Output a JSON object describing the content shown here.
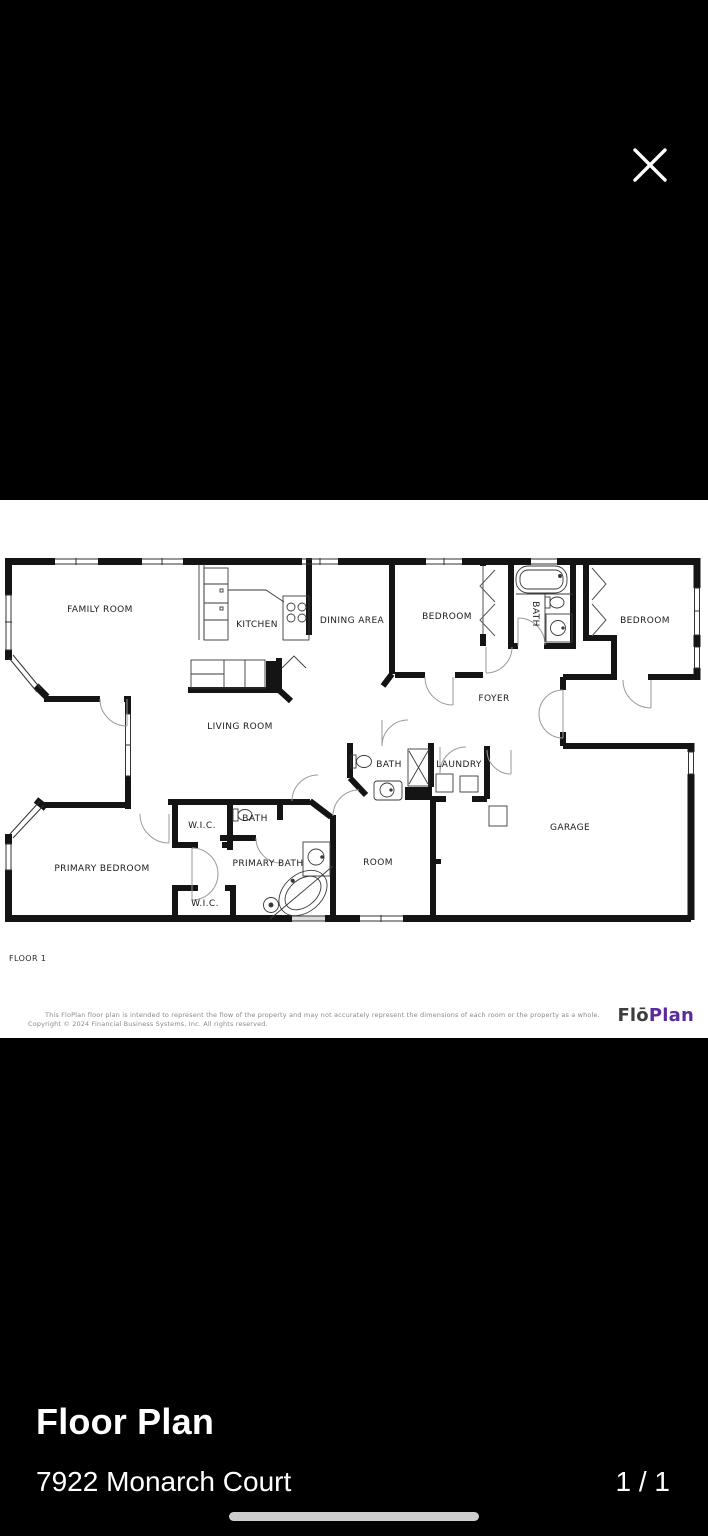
{
  "viewer": {
    "close_label": "close"
  },
  "floorplan": {
    "floor_label": "FLOOR 1",
    "labels": {
      "family_room": "FAMILY ROOM",
      "kitchen": "KITCHEN",
      "dining_area": "DINING AREA",
      "bedroom_left": "BEDROOM",
      "bath_top": "BATH",
      "bedroom_right": "BEDROOM",
      "foyer": "FOYER",
      "living_room": "LIVING ROOM",
      "bath_mid": "BATH",
      "laundry": "LAUNDRY",
      "wic_top": "W.I.C.",
      "bath_small": "BATH",
      "primary_bath": "PRIMARY BATH",
      "room": "ROOM",
      "garage": "GARAGE",
      "primary_bedroom": "PRIMARY BEDROOM",
      "wic_bottom": "W.I.C."
    },
    "disclaimer_line1": "This FloPlan floor plan is intended to represent the flow of the property and may not accurately represent the dimensions of each room or the property as a whole.",
    "disclaimer_line2": "Copyright © 2024 Financial Business Systems, Inc. All rights reserved.",
    "brand": {
      "flo": "Flō",
      "plan": "Plan"
    }
  },
  "footer": {
    "title": "Floor Plan",
    "subtitle": "7922 Monarch Court",
    "page_indicator": "1 / 1"
  },
  "colors": {
    "background": "#000000",
    "canvas": "#ffffff",
    "wall": "#141414",
    "brand_flo": "#3d3d3d",
    "brand_plan": "#5b2a9d",
    "footer_text": "#ffffff"
  }
}
